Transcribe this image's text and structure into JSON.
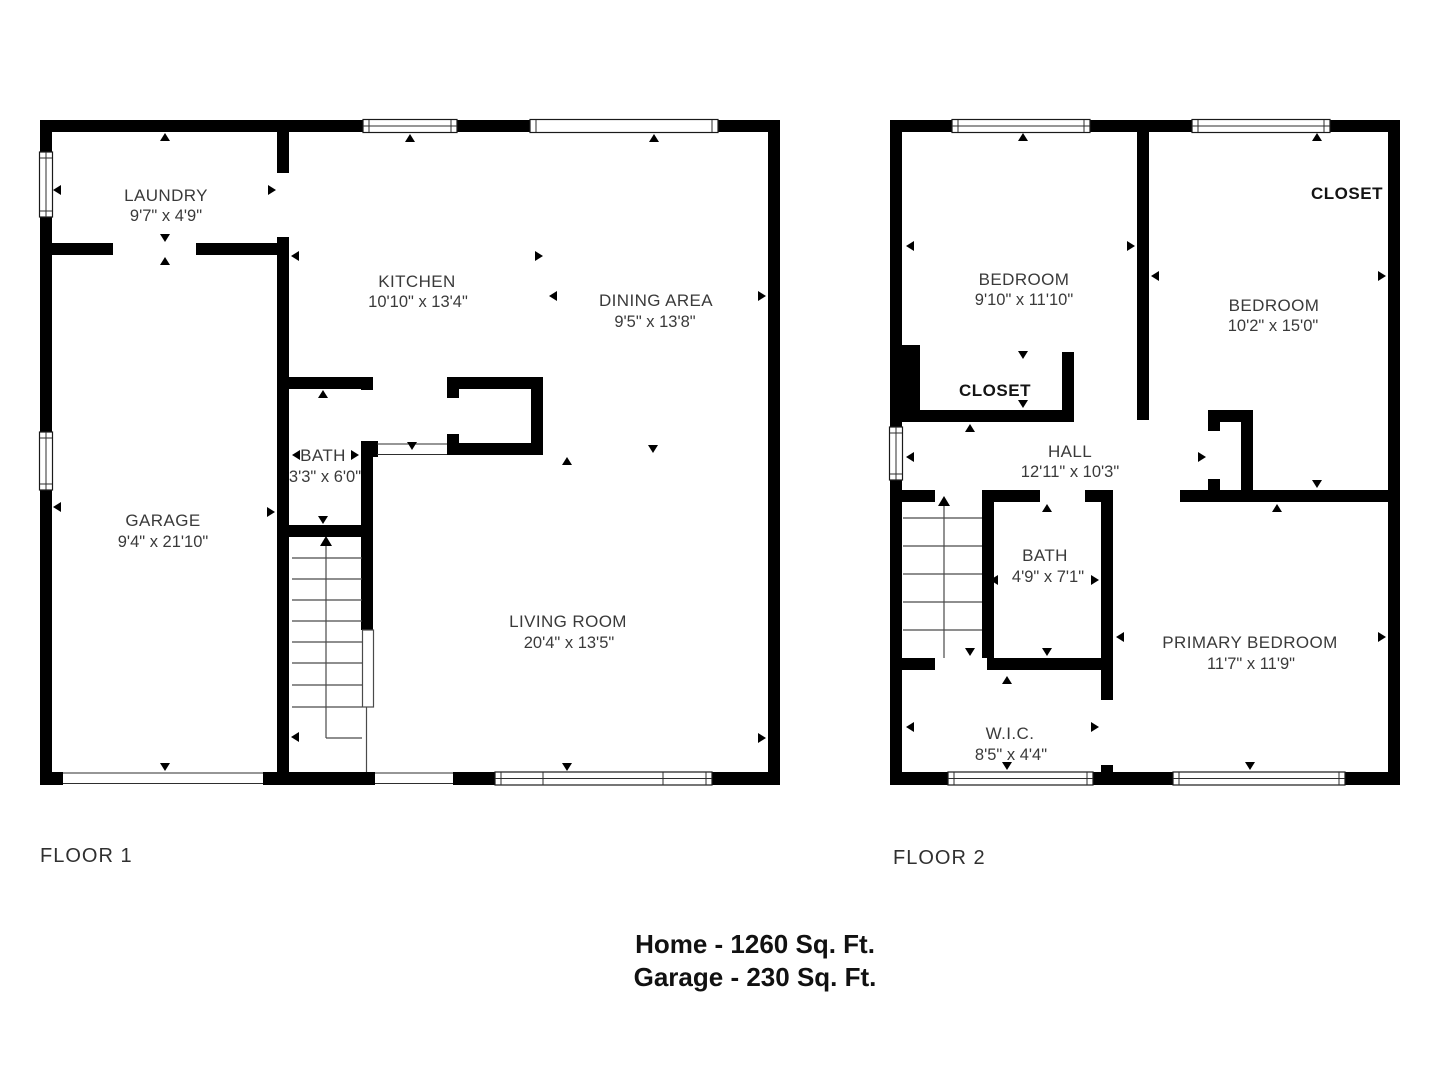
{
  "colors": {
    "wall": "#000000",
    "room_text": "#3a3a3a",
    "bold_text": "#141414"
  },
  "floor1": {
    "label": "FLOOR 1",
    "rooms": {
      "laundry": {
        "name": "LAUNDRY",
        "dims": "9'7\" x 4'9\""
      },
      "kitchen": {
        "name": "KITCHEN",
        "dims": "10'10\" x 13'4\""
      },
      "dining": {
        "name": "DINING AREA",
        "dims": "9'5\" x 13'8\""
      },
      "bath": {
        "name": "BATH",
        "dims": "3'3\" x 6'0\""
      },
      "garage": {
        "name": "GARAGE",
        "dims": "9'4\" x 21'10\""
      },
      "living": {
        "name": "LIVING ROOM",
        "dims": "20'4\" x 13'5\""
      }
    }
  },
  "floor2": {
    "label": "FLOOR 2",
    "rooms": {
      "bedroom1": {
        "name": "BEDROOM",
        "dims": "9'10\" x 11'10\""
      },
      "bedroom2": {
        "name": "BEDROOM",
        "dims": "10'2\" x 15'0\""
      },
      "closet_bedroom1": {
        "name": "CLOSET"
      },
      "closet_bedroom2": {
        "name": "CLOSET"
      },
      "hall": {
        "name": "HALL",
        "dims": "12'11\" x 10'3\""
      },
      "bath": {
        "name": "BATH",
        "dims": "4'9\" x 7'1\""
      },
      "primary": {
        "name": "PRIMARY BEDROOM",
        "dims": "11'7\" x 11'9\""
      },
      "wic": {
        "name": "W.I.C.",
        "dims": "8'5\" x 4'4\""
      }
    }
  },
  "footer": {
    "home": "Home - 1260 Sq. Ft.",
    "garage": "Garage - 230 Sq. Ft."
  }
}
